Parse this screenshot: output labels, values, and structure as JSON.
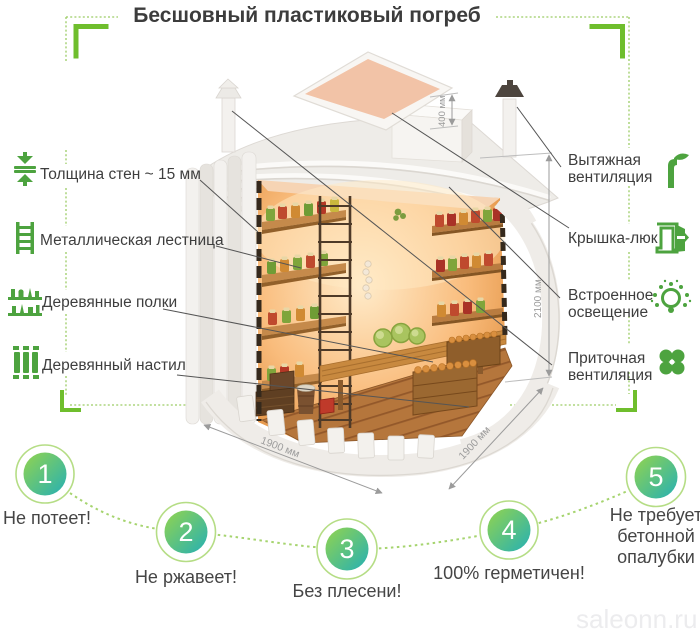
{
  "title": "Бесшовный пластиковый погреб",
  "watermark": "saleonn.ru",
  "features_left": [
    {
      "label": "Толщина стен ~ 15 мм",
      "icon": "wall-thickness-icon"
    },
    {
      "label": "Металлическая лестница",
      "icon": "ladder-icon"
    },
    {
      "label": "Деревянные полки",
      "icon": "shelves-icon"
    },
    {
      "label": "Деревянный настил",
      "icon": "flooring-icon"
    }
  ],
  "features_right": [
    {
      "label": "Вытяжная\nвентиляция",
      "icon": "exhaust-vent-icon"
    },
    {
      "label": "Крышка-люк",
      "icon": "hatch-icon"
    },
    {
      "label": "Встроенное\nосвещение",
      "icon": "light-icon"
    },
    {
      "label": "Приточная\nвентиляция",
      "icon": "supply-vent-icon"
    }
  ],
  "dimensions": {
    "lid": "400 мм",
    "height": "2100 мм",
    "width": "1900 мм",
    "depth": "1900 мм"
  },
  "benefits": [
    {
      "num": "1",
      "label": "Не потеет!"
    },
    {
      "num": "2",
      "label": "Не ржавеет!"
    },
    {
      "num": "3",
      "label": "Без плесени!"
    },
    {
      "num": "4",
      "label": "100% герметичен!"
    },
    {
      "num": "5",
      "label": "Не требует\nбетонной\nопалубки"
    }
  ],
  "colors": {
    "accent_green": "#6fbe2d",
    "icon_green": "#4da33f",
    "dotted_green": "#9ccc65",
    "circle_gradient_start": "#93d44e",
    "circle_gradient_end": "#25b0b4",
    "text_dark": "#3e3e3e",
    "dimension_gray": "#9b9b9b",
    "watermark_gray": "#ececee"
  }
}
